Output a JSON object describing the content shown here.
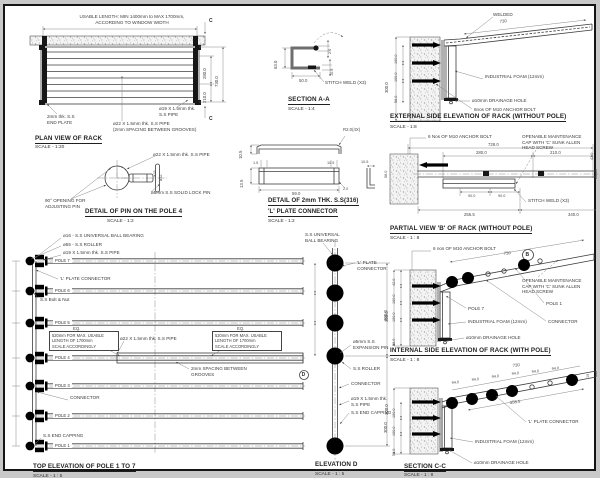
{
  "views": {
    "plan_view": {
      "note1": "USABLE LENGTH: MIN 1400mm to MAX 1700mm,",
      "note2": "ACCORDING TO WINDOW WIDTH",
      "end_plate": "2mm thk. S.S\nEND PLATE",
      "pipe19": "ø19 X 1.5mm thk.\nS.S PIPE",
      "pipe22": "ø22 X 1.5mm thk. S.S PIPE\n(2mm SPACING BETWEEN GROOVES)",
      "dim_280": "280.0",
      "dim_210": "210.0",
      "dim_730": "730.0",
      "marker_c_top": "C",
      "marker_c_bottom": "C",
      "title": "PLAN VIEW OF RACK",
      "scale": "SCALE - 1:20"
    },
    "pin_detail": {
      "pipe22": "ø22 X 1.5mm thk. S.S PIPE",
      "lock_pin": "ø5mm S.S SOLID LOCK PIN",
      "opening": "90° OPENING FOR\nADJUSTING PIN",
      "dim_19": "ø19",
      "dim_22": "ø22",
      "title": "DETAIL OF PIN ON THE POLE 4",
      "scale": "SCALE - 1:2"
    },
    "section_aa": {
      "dim_63": "63.0",
      "dim_50": "50.0",
      "dim_2": "2.0",
      "dim_105": "10.5",
      "stitch": "STITCH WELD (X3)",
      "title": "SECTION A-A",
      "scale": "SCALE - 1:4"
    },
    "l_plate": {
      "r2": "R2.0(4X)",
      "dim_105a": "10.5",
      "dim_15": "1.5",
      "dim_105b": "10.5",
      "dim_135": "13.5",
      "dim_59": "59.0",
      "dim_2": "2.0",
      "dim_105c": "10.5",
      "title1": "DETAIL  OF 2mm THK. S.S(316)",
      "title2": "'L' PLATE CONNECTOR",
      "scale": "SCALE - 1:2"
    },
    "top_elevation": {
      "ball_bearing": "ø16 - S.S UNIVERSAL BALL BEARING",
      "roller": "ø55 - S.S ROLLER",
      "pipe19": "ø19 X 1.5mm thk. S.S PIPE",
      "poles": [
        "POLE 7",
        "POLE 6",
        "POLE 5",
        "POLE 4",
        "POLE 3",
        "POLE 2",
        "POLE 1"
      ],
      "lplate": "'L' PLATE CONNECTOR",
      "bolt_nut": "S.S Bolt & Nut",
      "eq1": "EQ.",
      "eq2": "EQ.",
      "box_note": "520mm FOR MAX. USABLE\nLENGTH OF 1700mm\nSCALE ACCORDINGLY",
      "pipe22": "ø22 X 1.5mm thk. S.S PIPE",
      "spacing": "2mm SPACING BETWEEN\nGROOVES",
      "connector": "CONNECTOR",
      "end_capping": "S.S END CAPPING",
      "title": "TOP ELEVATION OF POLE 1  TO 7",
      "scale": "SCALE - 1 : 5"
    },
    "elevation_d": {
      "ball_bearing": "S.S UNIVERSAL\nBALL BEARING",
      "lplate": "'L' PLATE CONNECTOR",
      "expansion": "ø5mm S.S\nEXPANSION PIN",
      "roller": "S.S ROLLER",
      "connector": "CONNECTOR",
      "pipe19": "ø19 X 1.5mm thk.\nS.S PIPE",
      "end_capping": "S.S END CAPPING",
      "dim_300a": "300.0",
      "dim_300b": "300.0",
      "marker_d": "D",
      "title": "ELEVATION D",
      "scale": "SCALE - 1 : 5"
    },
    "external_elev": {
      "welded": "WELDED",
      "dim_730": "730",
      "foam": "INDUSTRIAL FOAM (12mm)",
      "drainage": "ø10mm DRAINAGE HOLE",
      "anchor": "6nos OF M10 ANCHOR BOLT",
      "dim_300": "300.0",
      "dim_100a": "100.0",
      "dim_100b": "100.0",
      "dim_58": "58.0",
      "title": "EXTERNAL SIDE ELEVATION OF RACK (WITHOUT POLE)",
      "scale": "SCALE - 1:8"
    },
    "partial_b": {
      "anchor": "6 Nos OF M10 ANCHOR BOLT",
      "cap": "OPENABLE  MAINTENANCE\nCAP WITH 'C' SUNK ALLEN\nHEAD SCREW",
      "dim_728": "728.0",
      "dim_280": "280.0",
      "dim_210": "210.0",
      "dim_42": "42.0",
      "dim_90a": "90.0",
      "dim_90b": "90.0",
      "dim_2555": "255.5",
      "dim_340": "340.0",
      "dim_58": "58.0",
      "stitch": "STITCH WELD (X3)",
      "title": "PARTIAL VIEW 'B' OF RACK (WITHOUT POLE)",
      "scale": "SCALE - 1 : 8"
    },
    "internal_elev": {
      "anchor": "6 nos OF M10 ANCHOR BOLT",
      "marker_b": "B",
      "dim_730": "730",
      "cap": "OPENABLE MAINTENANCE\nCAP WITH 'C' SUNK ALLEN\nHEAD SCREW",
      "pole1": "POLE 1",
      "pole7": "POLE 7",
      "foam": "INDUSTRIAL FOAM (12mm)",
      "connector": "CONNECTOR",
      "drainage": "ø10mm DRAINAGE HOLE",
      "dim_300": "300.0",
      "dim_42": "42.0",
      "dim_100a": "100.0",
      "dim_100b": "100.0",
      "dim_58": "58.0",
      "title": "INTERNAL SIDE ELEVATION OF RACK (WITH POLE)",
      "scale": "SCALE - 1 : 8"
    },
    "section_cc": {
      "dim_730": "730",
      "dims_94": [
        "94.0",
        "94.0",
        "94.0",
        "94.0",
        "94.0",
        "94.0"
      ],
      "dim_3585": "358.5",
      "dim_19": "19",
      "lplate": "'L' PLATE CONNECTOR",
      "foam": "INDUSTRIAL FOAM (12mm)",
      "drainage": "ø10mm DRAINAGE HOLE",
      "dim_300": "300.0",
      "dim_100a": "100.0",
      "dim_100b": "100.0",
      "dim_58": "58.0",
      "title": "SECTION C-C",
      "scale": "SCALE - 1 : 8"
    }
  }
}
